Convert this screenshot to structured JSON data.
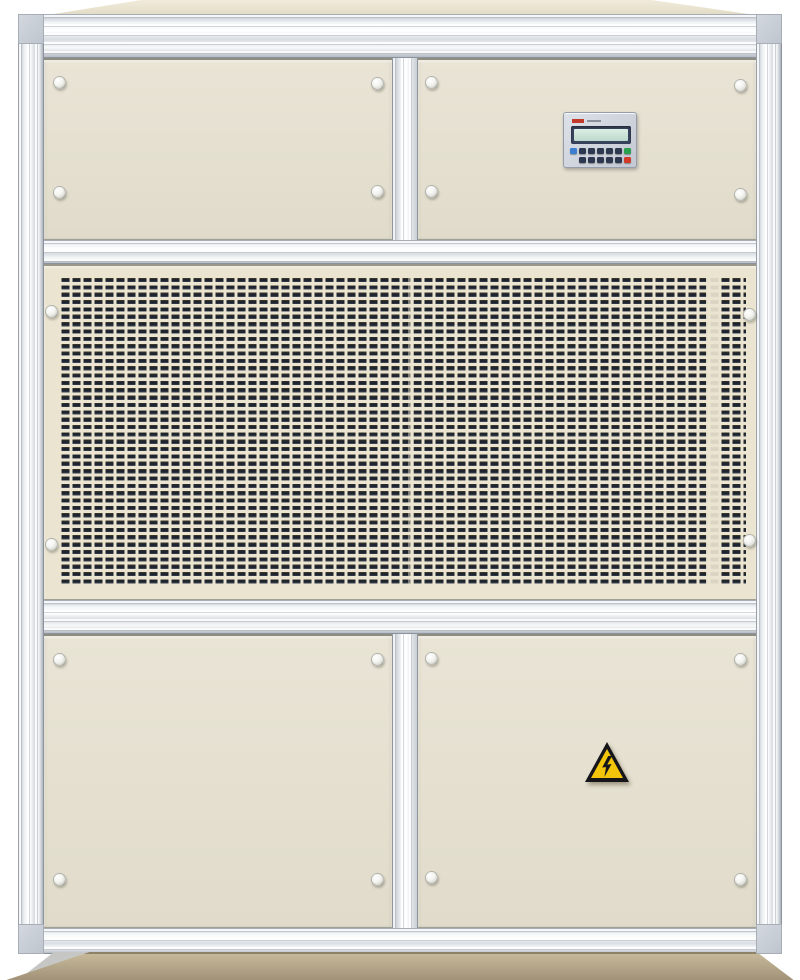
{
  "image": {
    "type": "photograph",
    "subject": "Industrial cabinet-style air handling / dehumidifier unit, front elevation on white background",
    "background_color": "#ffffff"
  },
  "unit": {
    "frame": {
      "material": "aluminum extrusion",
      "light": "#f4f6f8",
      "mid": "#d7dce2",
      "dark": "#b3b9c2"
    },
    "panels": {
      "color": "#e7e2d2",
      "top_row": "two access doors",
      "middle": "full-width perforated intake grille",
      "bottom_row": "two access doors"
    },
    "fasteners": {
      "style": "round white knobs",
      "color": "#f2f2ef",
      "count": 20
    },
    "lid_color": "#ece6d6"
  },
  "control_panel": {
    "location": "upper-right door",
    "bezel_color": "#ccd1da",
    "brand_mark_color": "#c0392b",
    "lcd": {
      "frame_color": "#39445e",
      "screen_color": "#cfe4d8"
    },
    "buttons": {
      "row1_colors": [
        "#3c7fd0",
        "#2d3850",
        "#2d3850",
        "#2d3850",
        "#2d3850",
        "#2d3850",
        "#2da04d"
      ],
      "row2_colors": [
        "#2d3850",
        "#2d3850",
        "#2d3850",
        "#2d3850",
        "#2d3850",
        "#d13a28"
      ]
    }
  },
  "grille": {
    "panel_color": "#eae4d0",
    "slot_color": "#1f2530",
    "slot_shape": "small horizontal rectangles",
    "approx_columns": 62,
    "approx_rows": 41
  },
  "warning_label": {
    "meaning": "high-voltage electrical hazard",
    "shape": "triangle",
    "fill_color": "#f3c50a",
    "border_color": "#15151a",
    "symbol": "lightning-bolt"
  },
  "base": {
    "plinth_color": "#b7a988"
  }
}
